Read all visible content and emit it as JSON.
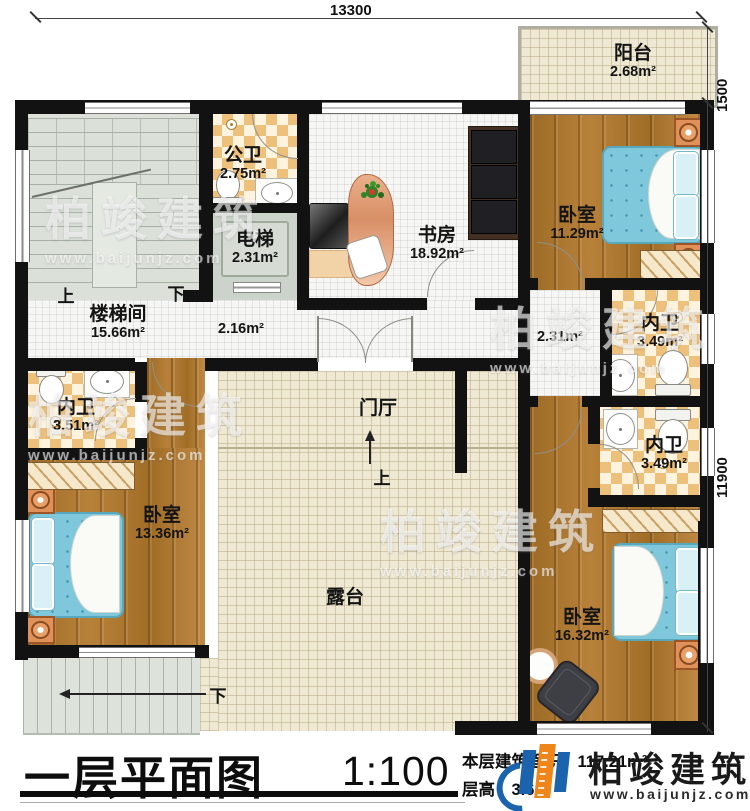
{
  "dimensions": {
    "top": "13300",
    "right_upper": "1500",
    "right_lower": "11900"
  },
  "rooms": [
    {
      "id": "stairwell",
      "name": "楼梯间",
      "area": "15.66m²"
    },
    {
      "id": "public_bath",
      "name": "公卫",
      "area": "2.75m²"
    },
    {
      "id": "elevator",
      "name": "电梯",
      "area": "2.31m²"
    },
    {
      "id": "study",
      "name": "书房",
      "area": "18.92m²"
    },
    {
      "id": "balcony",
      "name": "阳台",
      "area": "2.68m²"
    },
    {
      "id": "bedroom_ne",
      "name": "卧室",
      "area": "11.29m²"
    },
    {
      "id": "bath_ne",
      "name": "内卫",
      "area": "3.49m²"
    },
    {
      "id": "corridor_mid",
      "name": "",
      "area": "2.16m²"
    },
    {
      "id": "corridor_right",
      "name": "",
      "area": "2.31m²"
    },
    {
      "id": "bath_w",
      "name": "内卫",
      "area": "3.51m²"
    },
    {
      "id": "bedroom_sw",
      "name": "卧室",
      "area": "13.36m²"
    },
    {
      "id": "bath_se",
      "name": "内卫",
      "area": "3.49m²"
    },
    {
      "id": "bedroom_se",
      "name": "卧室",
      "area": "16.32m²"
    },
    {
      "id": "foyer",
      "name": "门厅",
      "area": ""
    },
    {
      "id": "terrace",
      "name": "露台",
      "area": ""
    }
  ],
  "annotations": {
    "stair_up": "上",
    "stair_down": "下",
    "entry_up": "上",
    "outdoor_down": "下"
  },
  "title_block": {
    "title": "一层平面图",
    "scale": "1:100",
    "area_label": "本层建筑面积：",
    "area_value": "117.21m²",
    "height_label": "层高：",
    "height_value": "3.6m"
  },
  "brand": {
    "name": "柏竣建筑",
    "url": "www.baijunjz.com"
  },
  "colors": {
    "wall": "#121212",
    "wood": "#ab772f",
    "tile_tan": "#edc07c",
    "bed_blue": "#7fc8dc",
    "logo_blue": "#1b63ad",
    "logo_orange": "#f08519"
  }
}
